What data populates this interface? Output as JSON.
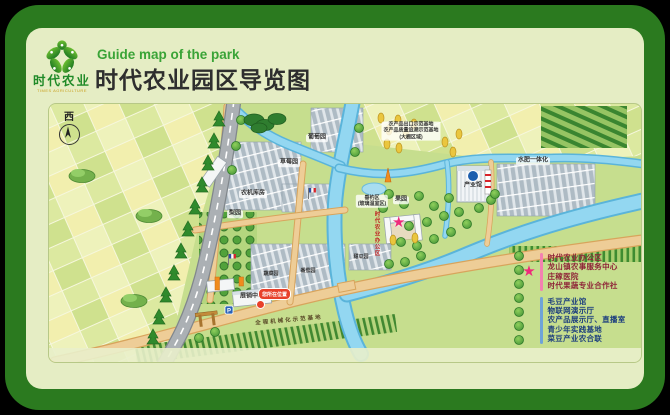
{
  "colors": {
    "frame_green": "#2b7a1f",
    "panel_green": "#e5edc4",
    "title_color": "#2e2e2e",
    "subtitle_green": "#3aa437",
    "star_pink": "#ee2a7b",
    "dot_blue": "#1d5fae",
    "you_are_here_red": "#e8402a",
    "river_blue": "#93d7f1"
  },
  "icons": {
    "star": "★"
  },
  "header": {
    "logo_title": "时代农业",
    "logo_tagline": "TIMES AGRICULTURE",
    "subtitle_en": "Guide map of the park",
    "title": "时代农业园区导览图"
  },
  "map": {
    "compass_label": "西",
    "you_are_here_label": "您所在位置",
    "parking_label": "P",
    "legend": {
      "star_items": [
        "时代农业办公区",
        "龙山镇农事服务中心",
        "庄稼医院",
        "时代果蔬专业合作社"
      ],
      "dot_items": [
        "毛豆产业馆",
        "物联网演示厅",
        "农产品展示厅、直播室",
        "青少年实践基地",
        "菜豆产业农合联"
      ]
    },
    "labels": [
      {
        "text": "农机库房",
        "x": 204,
        "y": 90,
        "cls": "chip"
      },
      {
        "text": "葡萄园",
        "x": 268,
        "y": 34,
        "cls": "chip"
      },
      {
        "text": "草莓园",
        "x": 240,
        "y": 59,
        "cls": "chip"
      },
      {
        "text": "农产品出口示范基地\n农产品质量追溯示范基地\n(大棚区域)",
        "x": 362,
        "y": 27,
        "cls": "small chip"
      },
      {
        "text": "水肥一体化",
        "x": 484,
        "y": 57,
        "cls": "chip"
      },
      {
        "text": "梨园",
        "x": 186,
        "y": 110,
        "cls": "chip"
      },
      {
        "text": "果园",
        "x": 352,
        "y": 96,
        "cls": "chip"
      },
      {
        "text": "垂钓区\n(玻璃温室区)",
        "x": 323,
        "y": 97,
        "cls": "small chip"
      },
      {
        "text": "产业馆",
        "x": 424,
        "y": 82,
        "cls": "plain"
      },
      {
        "text": "展销中心",
        "x": 203,
        "y": 193,
        "cls": "plain"
      },
      {
        "text": "全程机械化示范基地",
        "x": 240,
        "y": 217,
        "cls": "road",
        "rot": -5
      },
      {
        "text": "时代农业办公区",
        "x": 327,
        "y": 130,
        "cls": "v-red"
      },
      {
        "text": "蔬菜园",
        "x": 222,
        "y": 170,
        "cls": "small"
      },
      {
        "text": "番茄园",
        "x": 259,
        "y": 167,
        "cls": "small"
      },
      {
        "text": "甜瓜园",
        "x": 312,
        "y": 153,
        "cls": "small"
      }
    ]
  }
}
